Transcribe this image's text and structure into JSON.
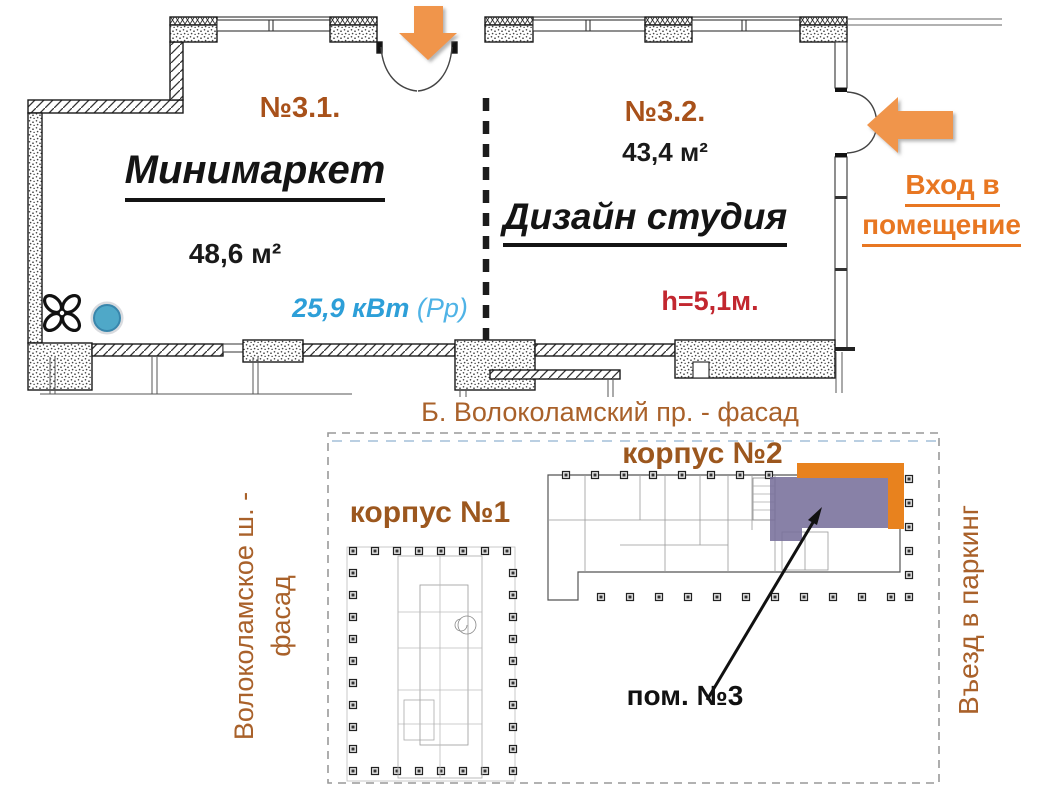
{
  "floor_plan": {
    "room1": {
      "number": "№3.1.",
      "name": "Минимаркет",
      "area": "48,6 м²",
      "power_value": "25,9 кВт",
      "power_note": "(Рр)"
    },
    "room2": {
      "number": "№3.2.",
      "area": "43,4 м²",
      "name": "Дизайн студия",
      "ceiling_height": "h=5,1м."
    },
    "entrance_line1": "Вход в",
    "entrance_line2": "помещение"
  },
  "site_plan": {
    "title": "Б. Волоколамский пр. - фасад",
    "building1_label": "корпус №1",
    "building2_label": "корпус №2",
    "unit_label": "пом. №3",
    "left_facade_line1": "Волоколамское ш. -",
    "left_facade_line2": "фасад",
    "parking_label": "Въезд в паркинг"
  },
  "colors": {
    "accent_orange": "#E87722",
    "arrow_orange": "#F0954C",
    "highlight_orange": "#E8821E",
    "highlight_purple": "#786F9B",
    "brown_label": "#9C571E",
    "power_blue": "#2D9FD8",
    "height_red": "#C2272F"
  },
  "icons": {
    "fan": "ventilation-fan",
    "marker": "blue-marker-dot",
    "arrow_down": "entrance-arrow-down",
    "arrow_left": "entrance-arrow-left",
    "pointer": "unit-pointer-arrow"
  }
}
